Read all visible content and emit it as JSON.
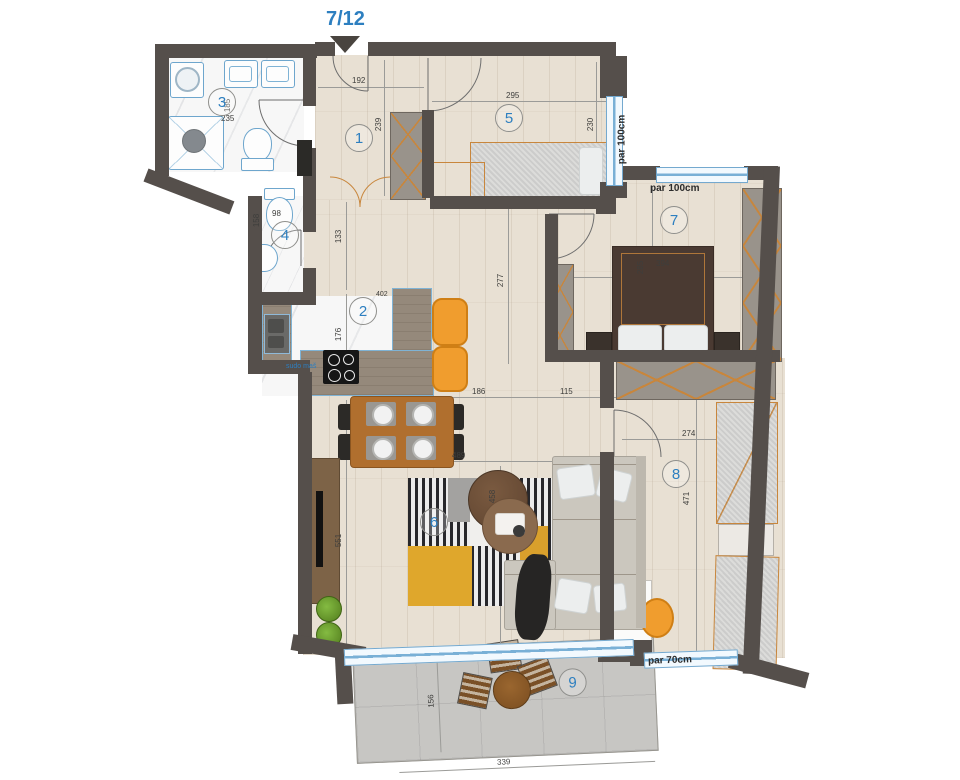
{
  "title": "7/12",
  "rooms": {
    "r1": "1",
    "r2": "2",
    "r3": "3",
    "r4": "4",
    "r5": "5",
    "r6": "6",
    "r7": "7",
    "r8": "8",
    "r9": "9"
  },
  "windows": {
    "room5_right": "par 100cm",
    "room7_top": "par 100cm",
    "room8_bottom": "par 70cm"
  },
  "labels": {
    "dishwasher": "sudo maš"
  },
  "dims": {
    "d192": "192",
    "d239": "239",
    "d295": "295",
    "d230": "230",
    "d185": "185",
    "d235": "235",
    "d158": "158",
    "d98": "98",
    "d133": "133",
    "d176": "176",
    "d402": "402",
    "d277": "277",
    "d186": "186",
    "d115": "115",
    "d285": "285",
    "d394": "394",
    "d489": "489",
    "d458": "458",
    "d551": "551",
    "d274": "274",
    "d471": "471",
    "d339": "339",
    "d156": "156"
  },
  "colors": {
    "accent": "#2d7fc0",
    "wall": "#554f4b",
    "window": "#74a9cf",
    "stool": "#f09d2e"
  }
}
